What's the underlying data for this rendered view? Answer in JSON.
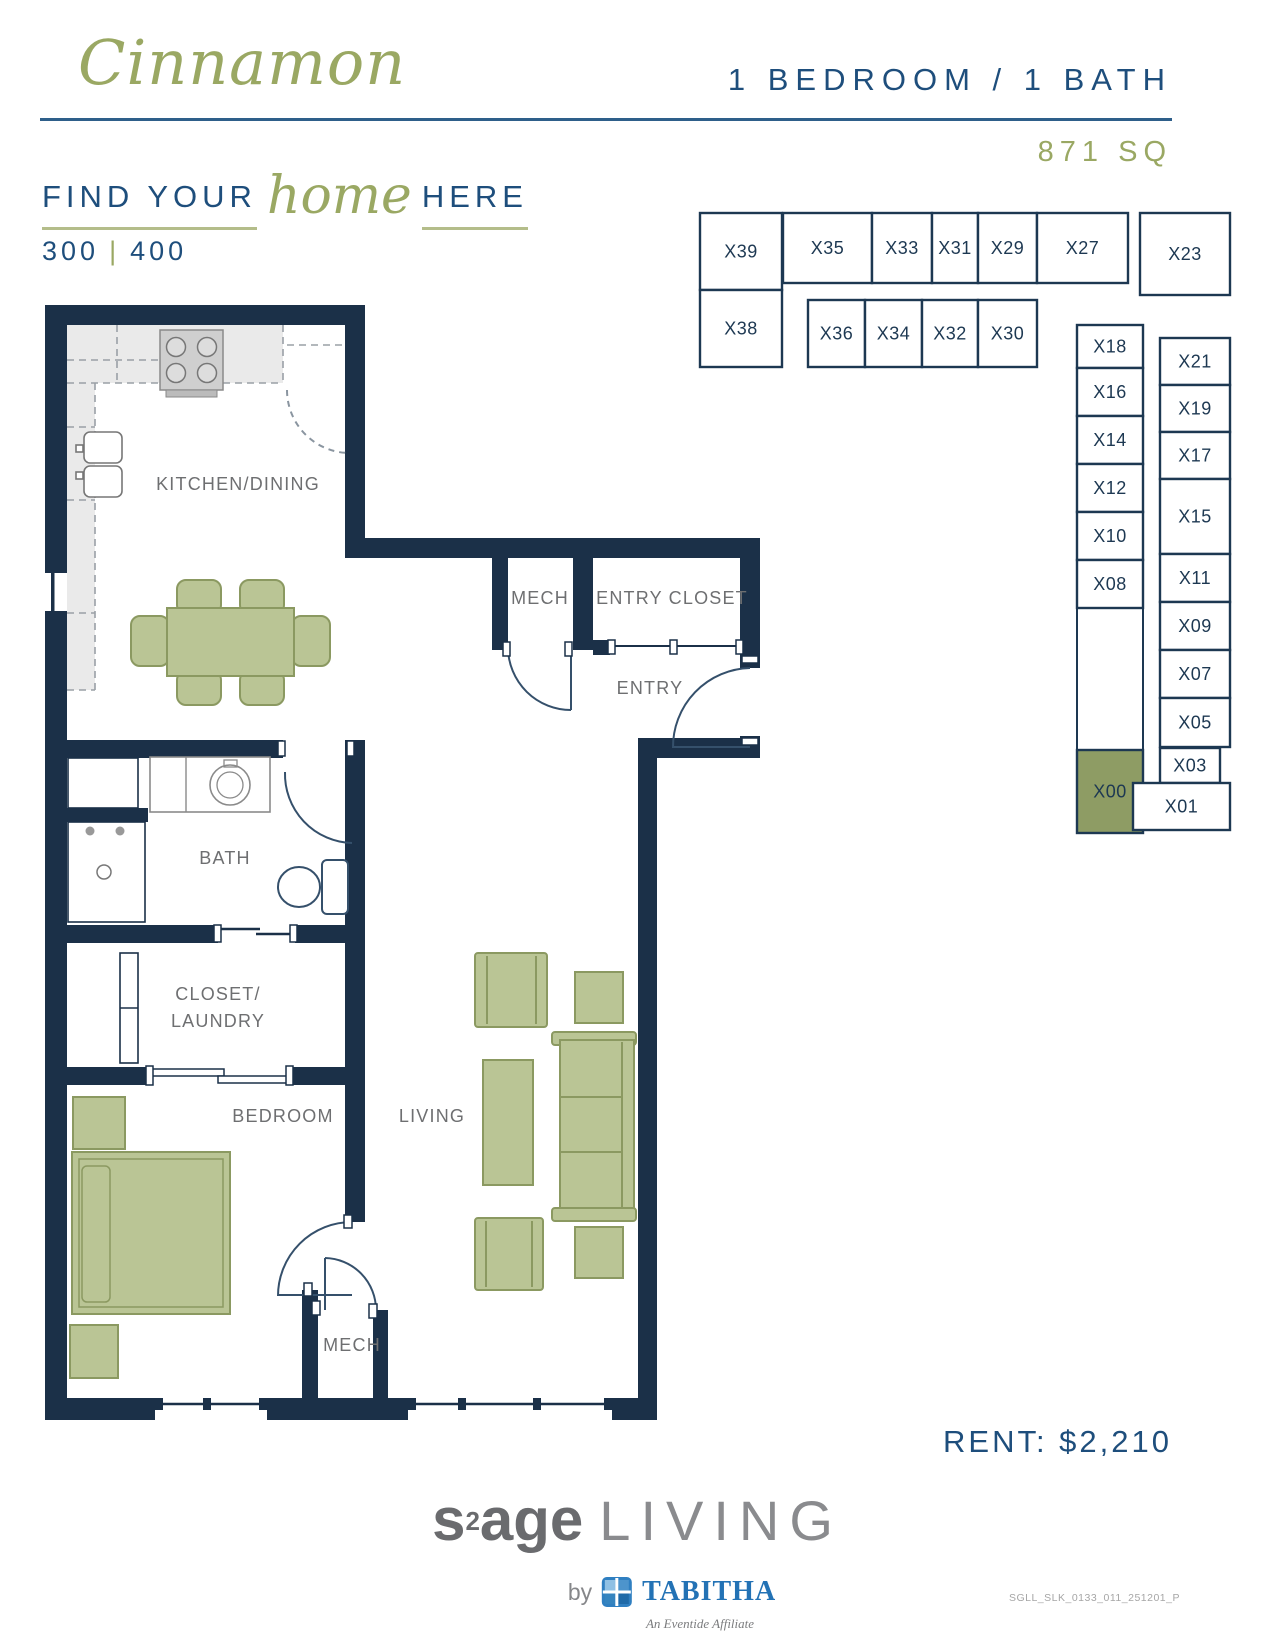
{
  "header": {
    "plan_name": "Cinnamon",
    "spec": "1 BEDROOM / 1 BATH",
    "size": "871 SQ"
  },
  "tagline": {
    "pre": "FIND YOUR",
    "script": "home",
    "post": "HERE",
    "floor_left": "300",
    "floor_right": "400",
    "separator": "|"
  },
  "pricing": {
    "rent": "RENT: $2,210"
  },
  "colors": {
    "navy": "#1b3048",
    "map_line": "#1d3852",
    "blue_text": "#1e4e7c",
    "green": "#9aa863",
    "furniture_fill": "#bac595",
    "furniture_stroke": "#8b9961",
    "highlight_fill": "#8e9c64",
    "counter_gray": "#eaeaea",
    "label_gray": "#6e6f71"
  },
  "unit_map": {
    "highlight_unit": "X00",
    "units": [
      {
        "id": "X39",
        "x": 700,
        "y": 213,
        "w": 82,
        "h": 77
      },
      {
        "id": "X38",
        "x": 700,
        "y": 290,
        "w": 82,
        "h": 77
      },
      {
        "id": "X35",
        "x": 783,
        "y": 213,
        "w": 89,
        "h": 70
      },
      {
        "id": "X33",
        "x": 872,
        "y": 213,
        "w": 60,
        "h": 70
      },
      {
        "id": "X31",
        "x": 932,
        "y": 213,
        "w": 46,
        "h": 70
      },
      {
        "id": "X29",
        "x": 978,
        "y": 213,
        "w": 59,
        "h": 70
      },
      {
        "id": "X27",
        "x": 1037,
        "y": 213,
        "w": 91,
        "h": 70
      },
      {
        "id": "X23",
        "x": 1140,
        "y": 213,
        "w": 90,
        "h": 82
      },
      {
        "id": "X36",
        "x": 808,
        "y": 300,
        "w": 57,
        "h": 67
      },
      {
        "id": "X34",
        "x": 865,
        "y": 300,
        "w": 57,
        "h": 67
      },
      {
        "id": "X32",
        "x": 922,
        "y": 300,
        "w": 56,
        "h": 67
      },
      {
        "id": "X30",
        "x": 978,
        "y": 300,
        "w": 59,
        "h": 67
      },
      {
        "id": "X18",
        "x": 1077,
        "y": 325,
        "w": 66,
        "h": 43
      },
      {
        "id": "X16",
        "x": 1077,
        "y": 368,
        "w": 66,
        "h": 48
      },
      {
        "id": "X14",
        "x": 1077,
        "y": 416,
        "w": 66,
        "h": 48
      },
      {
        "id": "X12",
        "x": 1077,
        "y": 464,
        "w": 66,
        "h": 48
      },
      {
        "id": "X10",
        "x": 1077,
        "y": 512,
        "w": 66,
        "h": 48
      },
      {
        "id": "X08",
        "x": 1077,
        "y": 560,
        "w": 66,
        "h": 48
      },
      {
        "id": "X00",
        "x": 1077,
        "y": 750,
        "w": 66,
        "h": 83,
        "highlight": true
      },
      {
        "id": "X21",
        "x": 1160,
        "y": 338,
        "w": 70,
        "h": 47
      },
      {
        "id": "X19",
        "x": 1160,
        "y": 385,
        "w": 70,
        "h": 47
      },
      {
        "id": "X17",
        "x": 1160,
        "y": 432,
        "w": 70,
        "h": 47
      },
      {
        "id": "X15",
        "x": 1160,
        "y": 479,
        "w": 70,
        "h": 75
      },
      {
        "id": "X11",
        "x": 1160,
        "y": 554,
        "w": 70,
        "h": 48
      },
      {
        "id": "X09",
        "x": 1160,
        "y": 602,
        "w": 70,
        "h": 48
      },
      {
        "id": "X07",
        "x": 1160,
        "y": 650,
        "w": 70,
        "h": 48
      },
      {
        "id": "X05",
        "x": 1160,
        "y": 698,
        "w": 70,
        "h": 49
      },
      {
        "id": "X03",
        "x": 1160,
        "y": 748,
        "w": 60,
        "h": 35
      },
      {
        "id": "X01",
        "x": 1133,
        "y": 783,
        "w": 97,
        "h": 47
      }
    ]
  },
  "floor_plan": {
    "labels": [
      {
        "text": "KITCHEN/DINING",
        "x": 238,
        "y": 490
      },
      {
        "text": "MECH",
        "x": 540,
        "y": 604
      },
      {
        "text": "ENTRY CLOSET",
        "x": 672,
        "y": 604
      },
      {
        "text": "ENTRY",
        "x": 650,
        "y": 694
      },
      {
        "text": "BATH",
        "x": 225,
        "y": 864
      },
      {
        "text": "CLOSET/",
        "x": 218,
        "y": 1000
      },
      {
        "text": "LAUNDRY",
        "x": 218,
        "y": 1027
      },
      {
        "text": "BEDROOM",
        "x": 283,
        "y": 1122
      },
      {
        "text": "LIVING",
        "x": 432,
        "y": 1122
      },
      {
        "text": "MECH",
        "x": 352,
        "y": 1351
      }
    ]
  },
  "footer": {
    "brand_s": "s",
    "brand_sup": "2",
    "brand_age": "age",
    "brand_living": "LIVING",
    "by": "by",
    "partner": "TABITHA",
    "affiliate": "An Eventide Affiliate",
    "doc_code": "SGLL_SLK_0133_011_251201_P"
  }
}
